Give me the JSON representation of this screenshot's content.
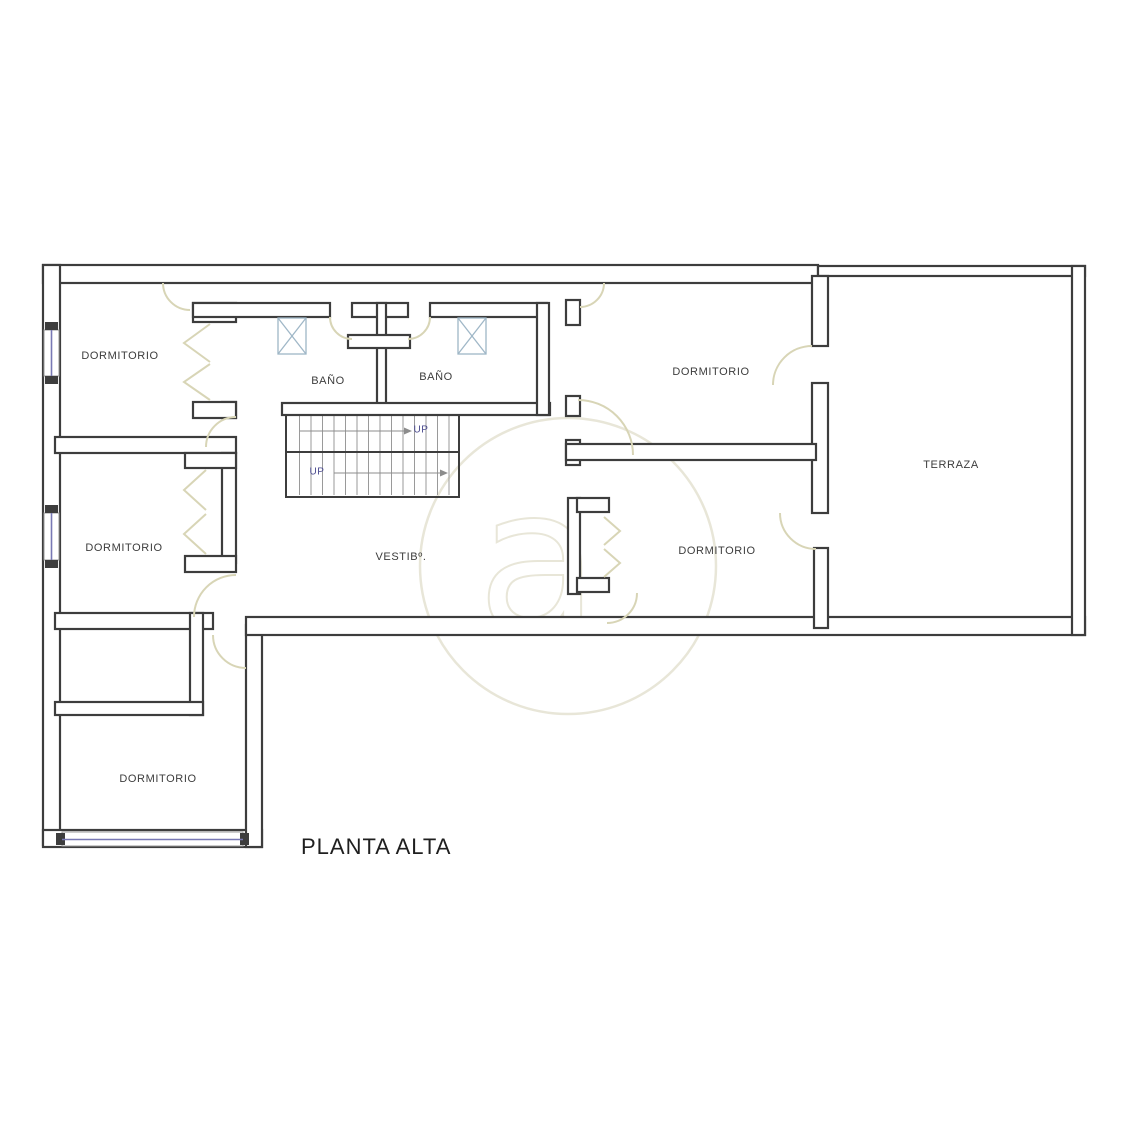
{
  "plan": {
    "title": "PLANTA ALTA",
    "rooms": {
      "dormitorio_top_left": "DORMITORIO",
      "dormitorio_mid_left": "DORMITORIO",
      "dormitorio_bottom_left": "DORMITORIO",
      "bano_left": "BAÑO",
      "bano_right": "BAÑO",
      "dormitorio_top_right": "DORMITORIO",
      "dormitorio_mid_right": "DORMITORIO",
      "terraza": "TERRAZA",
      "vestibulo": "VESTIBº."
    },
    "stairs": {
      "up_upper": "UP",
      "up_lower": "UP"
    },
    "watermark_letter": "a",
    "colors": {
      "wall": "#3d3d3d",
      "door_swing": "#d8d5b6",
      "window": "#7878b4",
      "fixture": "#9fb7c7",
      "watermark": "#e8e6d8",
      "stair_tread": "#9a9a9a",
      "up_text": "#4a4a8e"
    }
  }
}
